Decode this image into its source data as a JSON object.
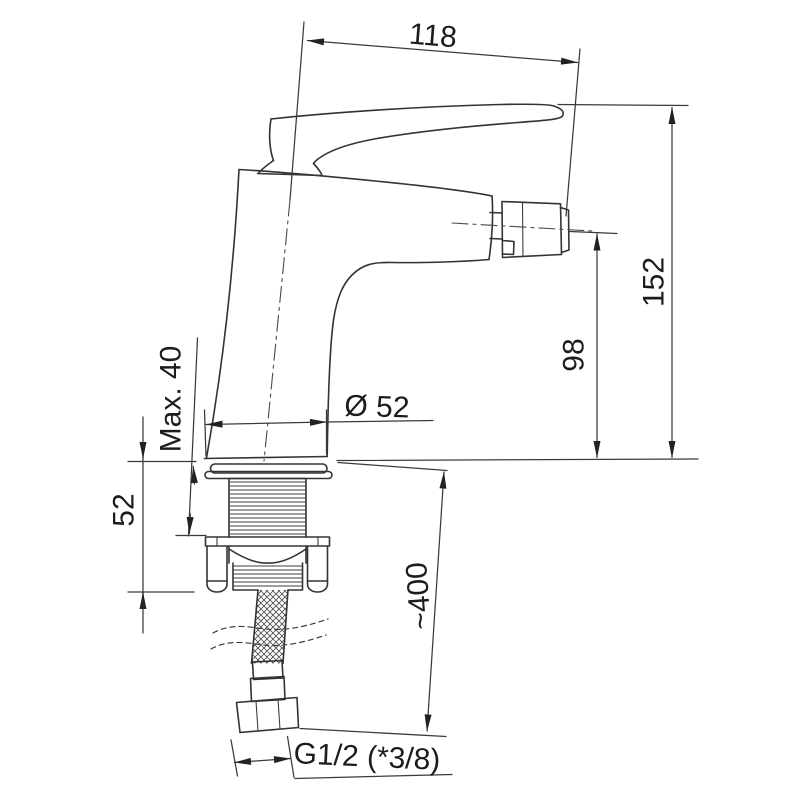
{
  "page": {
    "background": "#ffffff"
  },
  "drawing": {
    "type": "technical-dimension-drawing",
    "subject": "single-lever bidet mixer faucet, side elevation with mounting hardware and flexible hose",
    "line_color": "#333333",
    "text_color": "#1c1c1c",
    "dimensions": {
      "handle_to_spout_width": "118",
      "overall_height": "152",
      "spout_outlet_height": "98",
      "max_mounting_thickness": "Max. 40",
      "base_diameter": "Ø 52",
      "shank_clearance": "52",
      "hose_length": "~400",
      "connection_thread": "G1/2 (*3/8)"
    }
  }
}
